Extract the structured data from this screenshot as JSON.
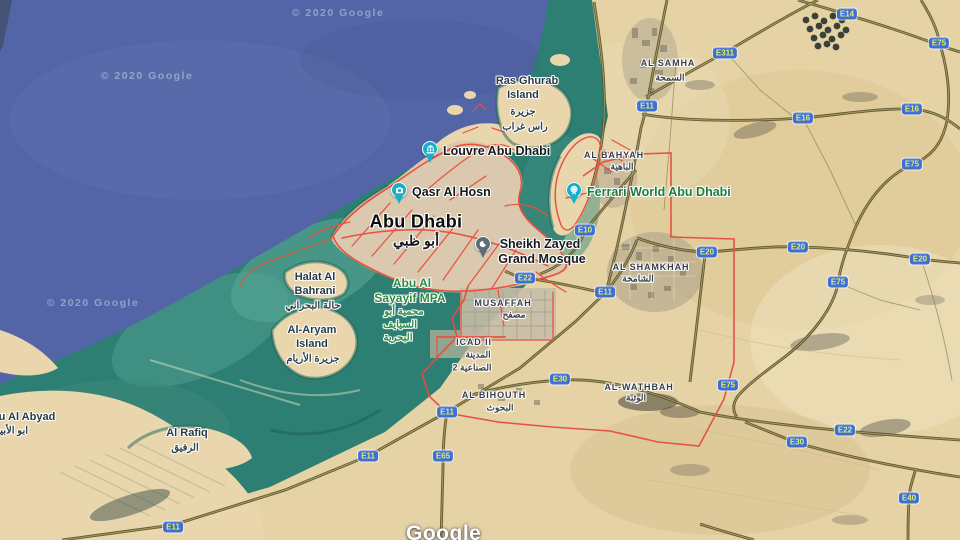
{
  "map": {
    "attribution": {
      "watermark": "© 2020 Google",
      "logo": "Google"
    },
    "city": {
      "name": "Abu Dhabi",
      "name_ar": "أبو ظبي"
    },
    "pois": {
      "louvre": {
        "name": "Louvre Abu Dhabi",
        "icon": "museum-icon",
        "pin_color": "#15b0c9"
      },
      "qasr": {
        "name": "Qasr Al Hosn",
        "icon": "camera-icon",
        "pin_color": "#15b0c9"
      },
      "ferrari": {
        "name": "Ferrari World Abu Dhabi",
        "icon": "ferris-wheel-icon",
        "pin_color": "#15b0c9"
      },
      "mosque": {
        "line1": "Sheikh Zayed",
        "line2": "Grand Mosque",
        "icon": "crescent-icon",
        "pin_color": "#5e6c78"
      }
    },
    "localities": {
      "al_samha": {
        "name": "AL SAMHA",
        "ar": "السمحة"
      },
      "al_bahyah": {
        "name": "AL BAHYAH",
        "ar": "الباهية"
      },
      "al_shamkhah": {
        "name": "AL SHAMKHAH",
        "ar": "الشامخة"
      },
      "al_wathbah": {
        "name": "AL-WATHBAH",
        "ar": "الوثبة"
      },
      "musaffah": {
        "name": "MUSAFFAH",
        "ar": "مصفح"
      },
      "al_bihouth": {
        "name": "AL BIHOUTH",
        "ar": "البحوث"
      },
      "icad": {
        "name": "ICAD II",
        "ar1": "المدينة",
        "ar2": "الصناعية 2"
      }
    },
    "islands": {
      "ras_ghurab": {
        "line1": "Ras Ghurab",
        "line2": "Island",
        "ar1": "جزيرة",
        "ar2": "راس غراب"
      },
      "halat": {
        "line1": "Halat Al",
        "line2": "Bahrani",
        "ar": "حالة البحراني"
      },
      "aryam": {
        "line1": "Al-Aryam",
        "line2": "Island",
        "ar": "جزيرة الأريام"
      },
      "rafiq": {
        "name": "Al Rafiq",
        "ar": "الرفيق"
      },
      "abyad": {
        "name": "Abu Al Abyad",
        "ar": "ابو الأبيض"
      }
    },
    "protected_area": {
      "line1": "Abu Al",
      "line2": "Sayayif MPA",
      "ar1": "محمية أبو",
      "ar2": "السيايف",
      "ar3": "البحرية"
    },
    "road_shields": {
      "e10": "E10",
      "e11": "E11",
      "e14": "E14",
      "e16": "E16",
      "e20": "E20",
      "e22": "E22",
      "e30": "E30",
      "e40": "E40",
      "e65": "E65",
      "e75": "E75",
      "e311": "E311"
    },
    "colors": {
      "ocean": "#5365a7",
      "shallow_water": "#2e7f73",
      "sand": "#e5d2a5",
      "highway": "#574f28",
      "city_road": "#e8513c",
      "boundary": "#e74c3c",
      "shield_bg": "#3d6fd7",
      "shield_text": "#e4ee66",
      "poi_pin": "#15b0c9",
      "mosque_pin": "#5e6c78",
      "park_label": "#1b7d3c"
    }
  }
}
